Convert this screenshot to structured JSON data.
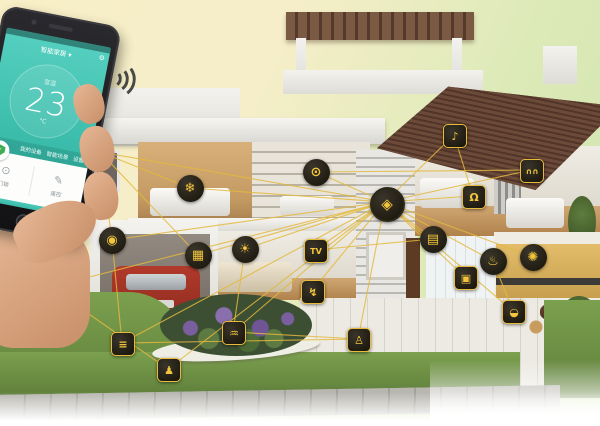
{
  "scene": {
    "subject": "smart-home cutaway house with connected device network and control phone",
    "background_top_color": "#f8efc7",
    "background_right_color": "#cfe3ae"
  },
  "network": {
    "line_color": "#e3b93e",
    "hub_id": "smart-gateway",
    "phone_anchor": {
      "x": 100,
      "y": 152
    },
    "phone_linked_ids": [
      "smart-gateway",
      "switch-panel",
      "security-camera",
      "ac-control"
    ],
    "extra_links": [
      [
        "security-camera",
        "garage-door"
      ],
      [
        "garage-remote",
        "irrigation-sprinkler"
      ],
      [
        "washing-machine",
        "curtains"
      ],
      [
        "doorbell",
        "door-lock"
      ],
      [
        "garden-watering",
        "motion-sensor"
      ],
      [
        "kitchen-faucet",
        "rice-cooker"
      ],
      [
        "tv",
        "power-socket"
      ],
      [
        "lighting",
        "garden-watering"
      ],
      [
        "garage-door",
        "motion-sensor"
      ]
    ]
  },
  "icons": [
    {
      "id": "ac-control",
      "glyph": "❄",
      "shape": "circle",
      "x": 190,
      "y": 188
    },
    {
      "id": "washing-machine",
      "glyph": "⊙",
      "shape": "circle",
      "x": 316,
      "y": 172
    },
    {
      "id": "doorbell",
      "glyph": "♪",
      "shape": "square",
      "x": 454,
      "y": 135
    },
    {
      "id": "curtains",
      "glyph": "∩∩",
      "shape": "square",
      "x": 531,
      "y": 170
    },
    {
      "id": "door-lock",
      "glyph": "Ω",
      "shape": "square",
      "x": 473,
      "y": 196
    },
    {
      "id": "smart-gateway",
      "glyph": "◈",
      "shape": "circle",
      "x": 385,
      "y": 202
    },
    {
      "id": "power-socket",
      "glyph": "▤",
      "shape": "circle",
      "x": 433,
      "y": 239
    },
    {
      "id": "switch-panel",
      "glyph": "▦",
      "shape": "circle",
      "x": 198,
      "y": 255
    },
    {
      "id": "lighting",
      "glyph": "☀",
      "shape": "circle",
      "x": 245,
      "y": 249
    },
    {
      "id": "tv",
      "glyph": "TV",
      "shape": "square",
      "x": 315,
      "y": 250
    },
    {
      "id": "security-camera",
      "glyph": "◉",
      "shape": "circle",
      "x": 112,
      "y": 240
    },
    {
      "id": "garage-remote",
      "glyph": "☝",
      "shape": "circle",
      "x": 50,
      "y": 287
    },
    {
      "id": "garage-door",
      "glyph": "≡",
      "shape": "square",
      "x": 122,
      "y": 343
    },
    {
      "id": "irrigation-sprinkler",
      "glyph": "♟",
      "shape": "square",
      "x": 168,
      "y": 369
    },
    {
      "id": "garden-watering",
      "glyph": "♒",
      "shape": "square",
      "x": 233,
      "y": 332
    },
    {
      "id": "outdoor-socket",
      "glyph": "↯",
      "shape": "square",
      "x": 312,
      "y": 291
    },
    {
      "id": "motion-sensor",
      "glyph": "♙",
      "shape": "square",
      "x": 358,
      "y": 339
    },
    {
      "id": "water-heater",
      "glyph": "▣",
      "shape": "square",
      "x": 465,
      "y": 277
    },
    {
      "id": "kitchen-faucet",
      "glyph": "♨",
      "shape": "circle",
      "x": 493,
      "y": 261
    },
    {
      "id": "exhaust-fan",
      "glyph": "✺",
      "shape": "circle",
      "x": 533,
      "y": 257
    },
    {
      "id": "rice-cooker",
      "glyph": "◒",
      "shape": "square",
      "x": 513,
      "y": 311
    }
  ],
  "phone": {
    "header_title": "智能家居",
    "header_caret": "▾",
    "gear_icon": "⚙",
    "temp_label": "室温",
    "temp_value": "23",
    "temp_unit": "°C",
    "shield_check": "✓",
    "menu_items": [
      "我的设备",
      "智能场景",
      "设置"
    ],
    "card_items": [
      {
        "icon": "⊙",
        "label": "门锁"
      },
      {
        "icon": "✎",
        "label": "遥控"
      }
    ]
  }
}
